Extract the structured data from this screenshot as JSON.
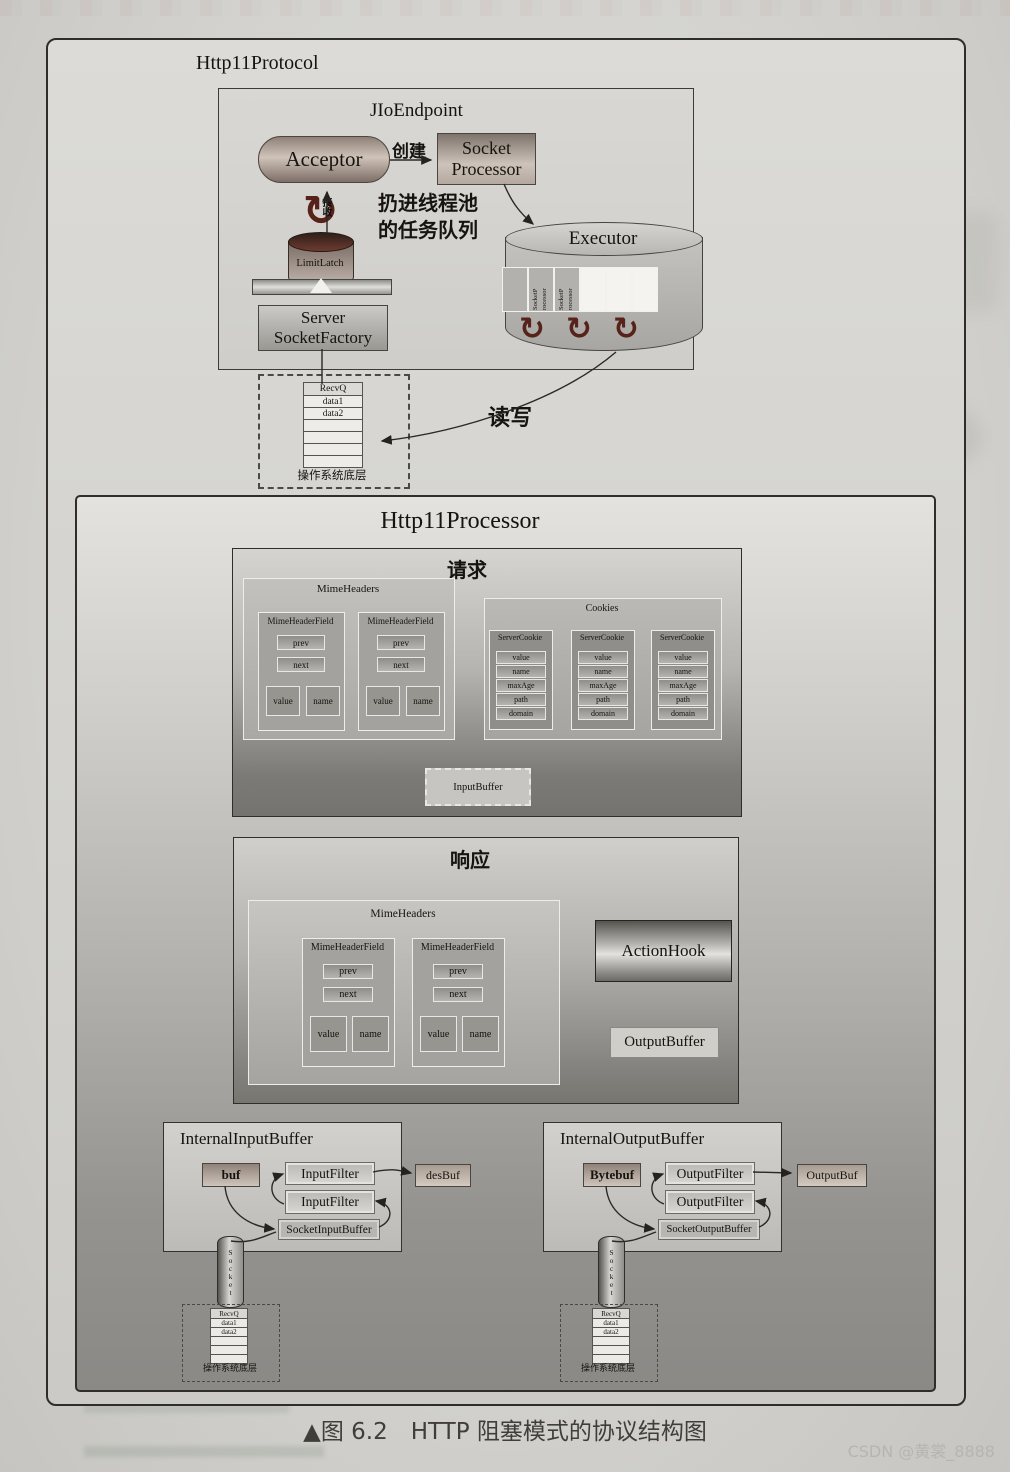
{
  "colors": {
    "page_bg": "#d4d3cf",
    "acceptor_fill": "#cfc3ba",
    "icon_maroon": "#57221a",
    "panel_dark": "#77766f",
    "ink": "#17140f"
  },
  "icons": {
    "recycle": "↻"
  },
  "figure": {
    "protocol_title": "Http11Protocol",
    "endpoint": {
      "title": "JIoEndpoint",
      "acceptor_label": "Acceptor",
      "create_label": "创建",
      "socket_processor_label": "Socket Processor",
      "enqueue_label_line1": "扔进线程池",
      "enqueue_label_line2": "的任务队列",
      "receive_label": "接收",
      "limit_latch_label": "LimitLatch",
      "server_socket_factory_label": "Server SocketFactory",
      "executor": {
        "title": "Executor",
        "queue_cells": [
          {
            "text": "SocketP rocessor"
          },
          {
            "text": "SocketP rocessor"
          },
          {
            "text": "SocketP rocessor"
          },
          {
            "text": ""
          },
          {
            "text": ""
          },
          {
            "text": ""
          }
        ]
      }
    },
    "os_layer_top": {
      "rows": [
        "RecvQ",
        "data1",
        "data2",
        "",
        "",
        "",
        ""
      ],
      "label": "操作系统底层"
    },
    "read_write_label": "读写"
  },
  "processor": {
    "title": "Http11Processor",
    "request": {
      "title": "请求",
      "mime_headers": {
        "title": "MimeHeaders",
        "fields": [
          {
            "title": "MimeHeaderField",
            "prev": "prev",
            "next": "next",
            "value": "value",
            "name": "name"
          },
          {
            "title": "MimeHeaderField",
            "prev": "prev",
            "next": "next",
            "value": "value",
            "name": "name"
          }
        ]
      },
      "cookies": {
        "title": "Cookies",
        "items": [
          {
            "title": "ServerCookie",
            "rows": [
              "value",
              "name",
              "maxAge",
              "path",
              "domain"
            ]
          },
          {
            "title": "ServerCookie",
            "rows": [
              "value",
              "name",
              "maxAge",
              "path",
              "domain"
            ]
          },
          {
            "title": "ServerCookie",
            "rows": [
              "value",
              "name",
              "maxAge",
              "path",
              "domain"
            ]
          }
        ]
      },
      "input_buffer_label": "InputBuffer"
    },
    "response": {
      "title": "响应",
      "mime_headers": {
        "title": "MimeHeaders",
        "fields": [
          {
            "title": "MimeHeaderField",
            "prev": "prev",
            "next": "next",
            "value": "value",
            "name": "name"
          },
          {
            "title": "MimeHeaderField",
            "prev": "prev",
            "next": "next",
            "value": "value",
            "name": "name"
          }
        ]
      },
      "action_hook_label": "ActionHook",
      "output_buffer_label": "OutputBuffer"
    },
    "input_side": {
      "title": "InternalInputBuffer",
      "buf_label": "buf",
      "filter1_label": "InputFilter",
      "filter2_label": "InputFilter",
      "socket_buffer_label": "SocketInputBuffer",
      "dest_label": "desBuf",
      "pipe_label": "Socket",
      "os_layer": {
        "rows": [
          "RecvQ",
          "data1",
          "data2",
          "",
          "",
          ""
        ],
        "label": "操作系统底层"
      }
    },
    "output_side": {
      "title": "InternalOutputBuffer",
      "buf_label": "Bytebuf",
      "filter1_label": "OutputFilter",
      "filter2_label": "OutputFilter",
      "socket_buffer_label": "SocketOutputBuffer",
      "dest_label": "OutputBuf",
      "pipe_label": "Socket",
      "os_layer": {
        "rows": [
          "RecvQ",
          "data1",
          "data2",
          "",
          "",
          ""
        ],
        "label": "操作系统底层"
      }
    }
  },
  "caption": "▲图 6.2　HTTP 阻塞模式的协议结构图",
  "watermark": "CSDN @黄裳_8888"
}
